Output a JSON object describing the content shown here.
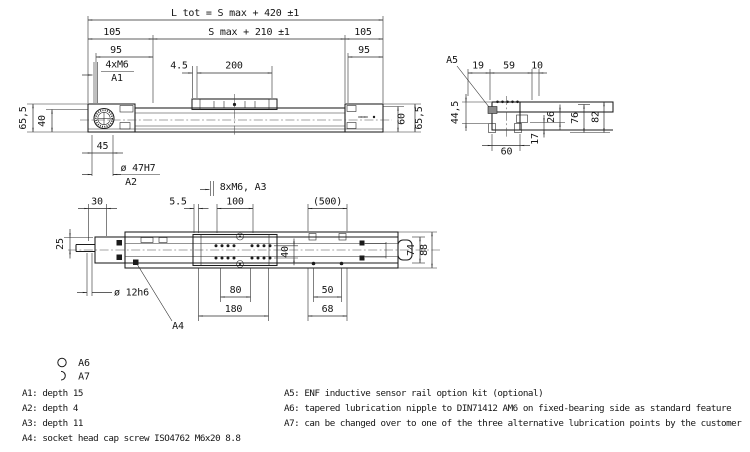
{
  "side_view": {
    "dim_l_tot": "L tot = S max + 420 ±1",
    "dim_smax": "S max + 210 ±1",
    "dim_105_left": "105",
    "dim_105_right": "105",
    "dim_95_left": "95",
    "dim_95_right": "95",
    "label_4xm6": "4xM6",
    "label_a1": "A1",
    "dim_4_5": "4.5",
    "dim_200": "200",
    "dim_65_5_left": "65,5",
    "dim_40": "40",
    "dim_45": "45",
    "dim_dia47": "ø 47H7",
    "label_a2": "A2",
    "label_8xm6": "8xM6, A3",
    "dim_60_right": "60",
    "dim_65_5_right": "65,5"
  },
  "section_view": {
    "label_a5": "A5",
    "dim_19": "19",
    "dim_59": "59",
    "dim_10": "10",
    "dim_44_5": "44,5",
    "dim_76": "76",
    "dim_82": "82",
    "dim_26": "26",
    "dim_17": "17",
    "dim_60": "60"
  },
  "plan_view": {
    "dim_30": "30",
    "dim_5_5": "5.5",
    "dim_100": "100",
    "dim_500": "(500)",
    "dim_25": "25",
    "dim_dia12": "ø 12h6",
    "dim_40": "40",
    "dim_74": "74",
    "dim_88": "88",
    "dim_80": "80",
    "dim_180": "180",
    "dim_50": "50",
    "dim_68": "68",
    "label_a4": "A4"
  },
  "legend": {
    "a6_label": "A6",
    "a7_label": "A7"
  },
  "notes_left": [
    "A1: depth 15",
    "A2: depth 4",
    "A3: depth 11",
    "A4: socket head cap screw ISO4762 M6x20 8.8"
  ],
  "notes_right": [
    "A5: ENF inductive sensor rail option kit (optional)",
    "A6: tapered lubrication nipple to DIN71412 AM6 on fixed-bearing side as standard feature",
    "A7: can be changed over to one of the three alternative lubrication points by the customer"
  ],
  "colors": {
    "line": "#1b1b1b",
    "background": "#ffffff",
    "sensor_block": "#8a8a8a"
  }
}
